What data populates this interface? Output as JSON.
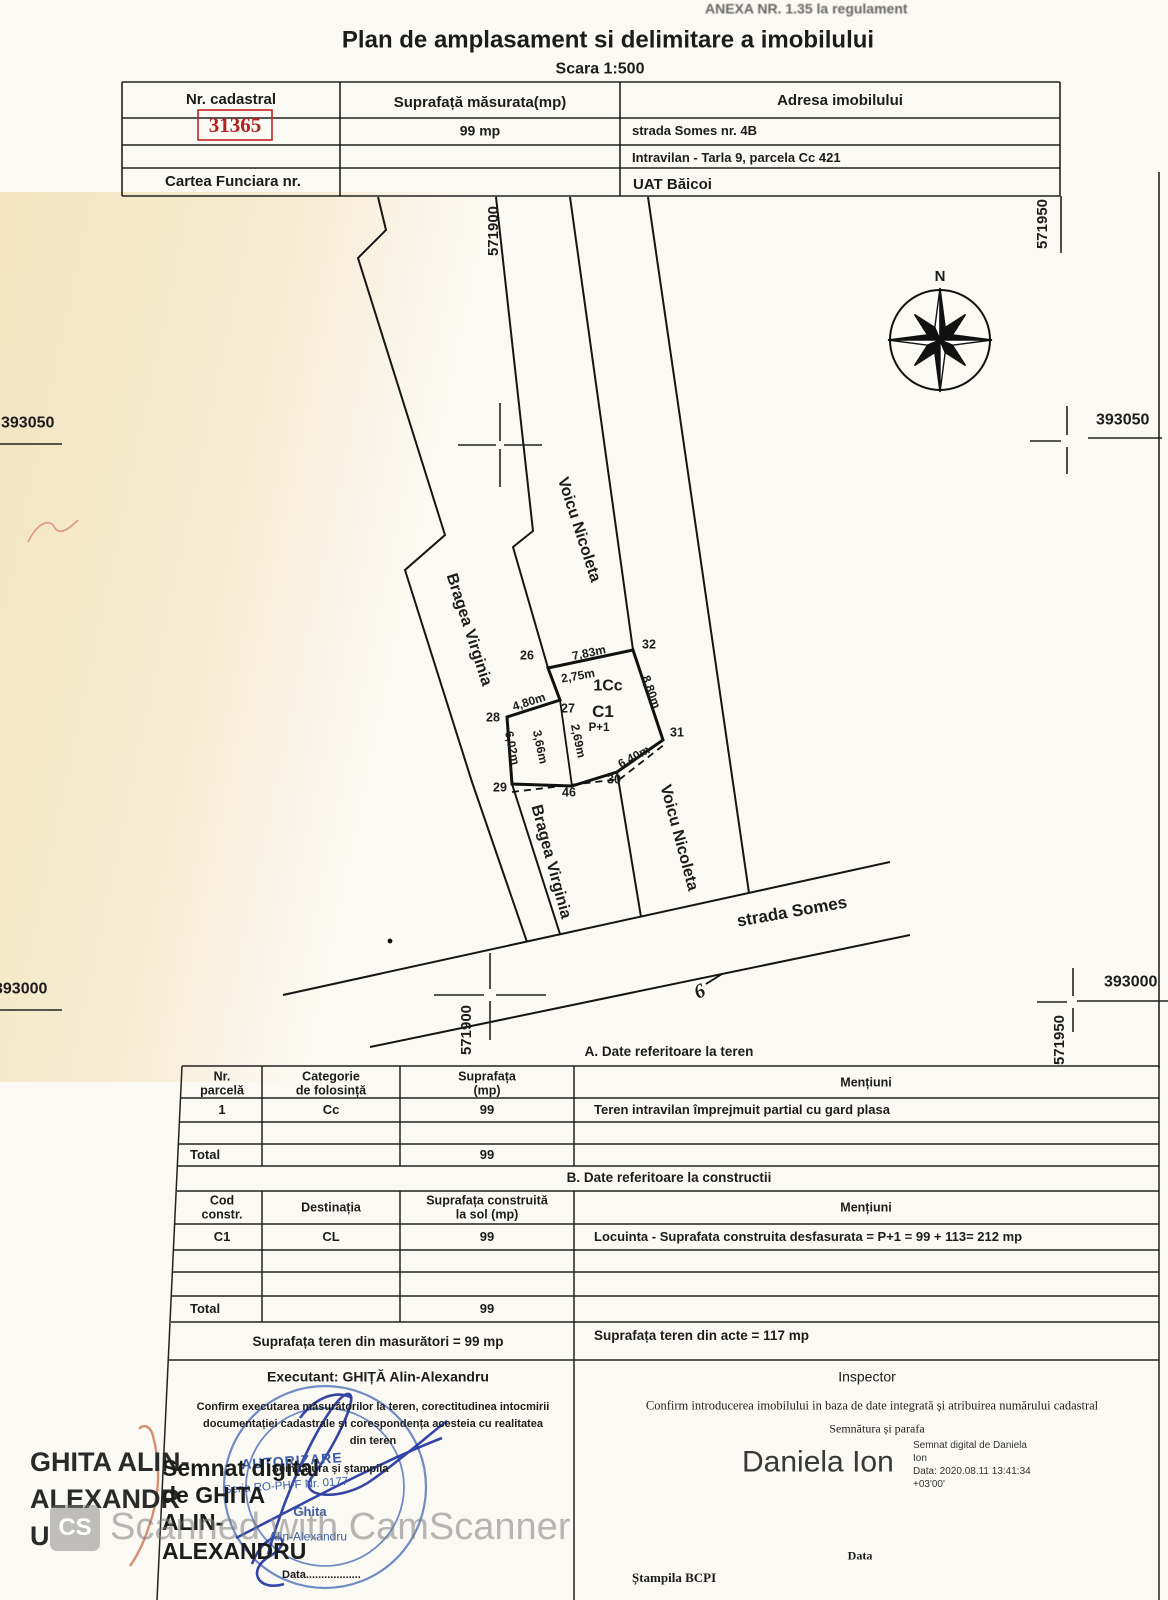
{
  "page": {
    "annex_note": "ANEXA NR. 1.35 la regulament",
    "title": "Plan de amplasament si delimitare a imobilului",
    "scale": "Scara 1:500"
  },
  "watermark": {
    "logo": "CS",
    "text": "Scanned with CamScanner"
  },
  "header_table": {
    "nr_cadastral_label": "Nr. cadastral",
    "cadastral_number": "31365",
    "suprafata_label": "Suprafață măsurata(mp)",
    "adresa_label": "Adresa imobilului",
    "measured_area": "99 mp",
    "address_line1": "strada Somes nr. 4B",
    "address_line2": "Intravilan - Tarla 9, parcela Cc 421",
    "cartea_funciara_label": "Cartea Funciara nr.",
    "uat": "UAT  Băicoi"
  },
  "plan": {
    "compass_north": "N",
    "grid": {
      "top_e": "571900",
      "top_right_e": "571950",
      "left_n": "393050",
      "right_n": "393050",
      "bottom_left_n": "393000",
      "bottom_right_n": "393000",
      "bottom_e": "571900",
      "bottom_right_e2": "571950"
    },
    "owners": {
      "west1": "Bragea Virginia",
      "east1": "Voicu Nicoleta",
      "west2": "Bragea Virginia",
      "east2": "Voicu Nicoleta"
    },
    "street": "strada Somes",
    "parcel_label": "1Cc",
    "building_label": "C1",
    "building_regime": "P+1",
    "symbol6": "6",
    "points": [
      "26",
      "27",
      "28",
      "29",
      "30",
      "31",
      "32",
      "46"
    ],
    "dims": [
      "7,83m",
      "2,75m",
      "4,80m",
      "6,02m",
      "3,66m",
      "2,69m",
      "6,40m",
      "8,80m"
    ]
  },
  "table_a": {
    "section_title": "A. Date referitoare la teren",
    "h_col1_l1": "Nr.",
    "h_col1_l2": "parcelă",
    "h_col2_l1": "Categorie",
    "h_col2_l2": "de folosință",
    "h_col3_l1": "Suprafața",
    "h_col3_l2": "(mp)",
    "h_col4": "Mențiuni",
    "row1": {
      "nr": "1",
      "cat": "Cc",
      "sup": "99",
      "mentiuni": "Teren intravilan împrejmuit partial cu gard plasa"
    },
    "total_label": "Total",
    "total_sup": "99"
  },
  "table_b": {
    "section_title": "B. Date referitoare la constructii",
    "h_col1_l1": "Cod",
    "h_col1_l2": "constr.",
    "h_col2": "Destinația",
    "h_col3_l1": "Suprafața construită",
    "h_col3_l2": "la sol (mp)",
    "h_col4": "Mențiuni",
    "row1": {
      "cod": "C1",
      "dest": "CL",
      "sup": "99",
      "mentiuni": "Locuinta - Suprafata construita desfasurata = P+1 = 99 + 113= 212 mp"
    },
    "total_label": "Total",
    "total_sup": "99",
    "area_measured": "Suprafața teren din masurători = 99 mp",
    "area_acts": "Suprafața teren din acte = 117 mp"
  },
  "footer": {
    "executant": {
      "label": "Executant:  GHIȚĂ Alin-Alexandru",
      "confirm_l1": "Confirm executarea măsurătorilor la teren, corectitudinea intocmirii",
      "confirm_l2": "documentației cadastrale și corespondența acesteia cu realitatea",
      "confirm_l3": "din teren",
      "sign_label": "Semnătura și ștampila",
      "date_label": "Data..................",
      "stamp_l1": "AUTORIZARE",
      "stamp_l2": "Seria RO-PH-F Nr. 0177",
      "stamp_l3": "Ghita",
      "stamp_l4": "Alin-Alexandru",
      "overlay_l1": "GHITA ALIN-",
      "overlay_l2": "ALEXANDR",
      "overlay_l3": "U",
      "digital_l1": "Semnat digital",
      "digital_l2": "de GHITA",
      "digital_l3": "ALIN-",
      "digital_l4": "ALEXANDRU"
    },
    "inspector": {
      "label": "Inspector",
      "confirm": "Confirm introducerea imobilului in baza de date integrată și atribuirea numărului cadastral",
      "sign_label": "Semnătura și parafa",
      "signer_name": "Daniela Ion",
      "digital_l1": "Semnat digital de Daniela",
      "digital_l2": "Ion",
      "digital_l3": "Data: 2020.08.11 13:41:34",
      "digital_l4": "+03'00'",
      "date_label": "Data",
      "stamp_label": "Ștampila BCPI"
    }
  }
}
